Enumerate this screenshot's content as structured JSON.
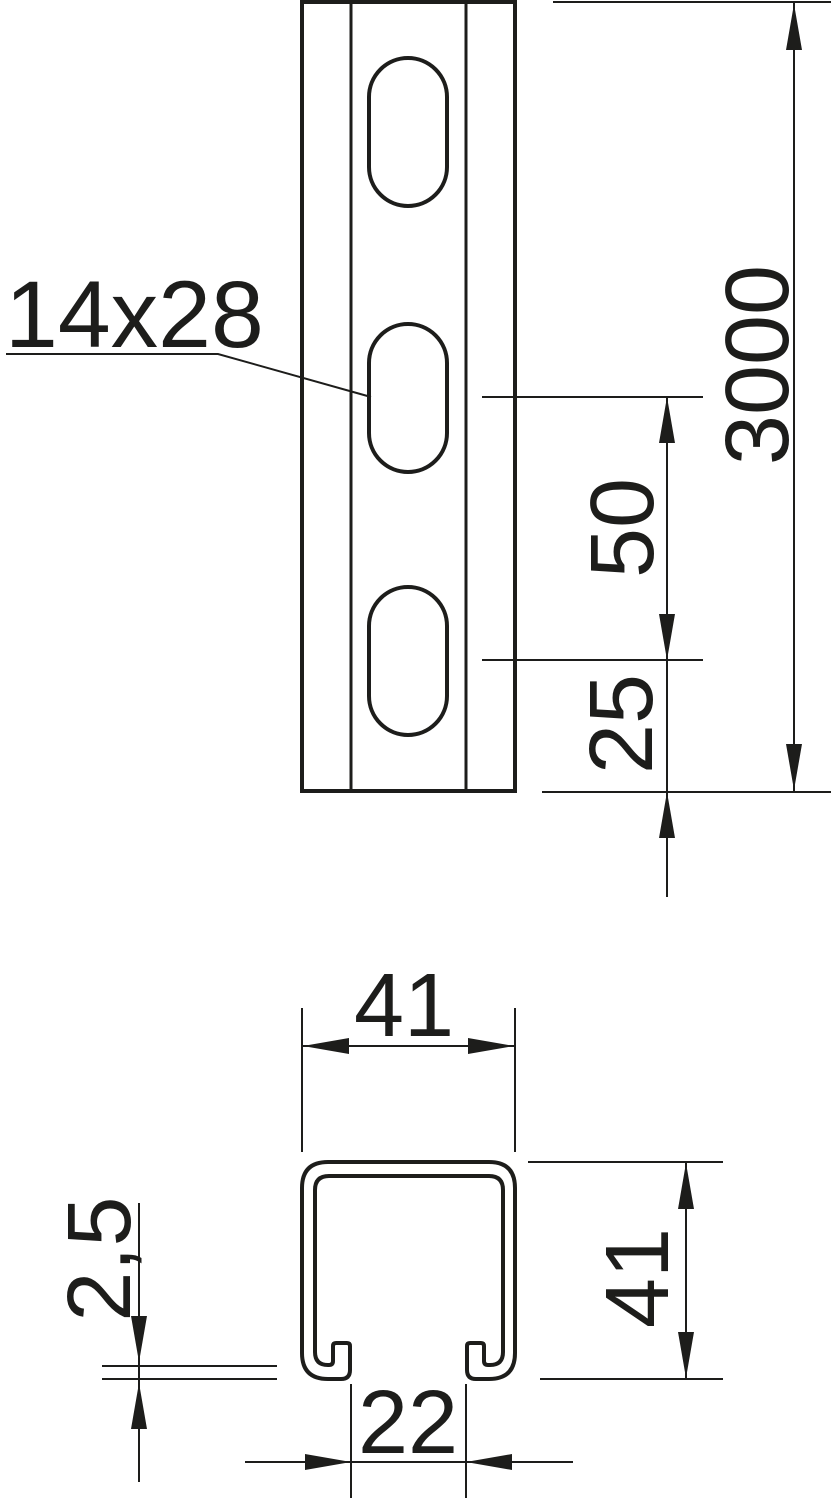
{
  "colors": {
    "ink": "#1d1d1b",
    "background": "#ffffff"
  },
  "front_view": {
    "slot_size_label": "14x28",
    "slot_pitch": "50",
    "end_distance": "25",
    "profile_length": "3000"
  },
  "section_view": {
    "outer_width": "41",
    "outer_height": "41",
    "material_thickness": "2,5",
    "slot_opening": "22"
  }
}
